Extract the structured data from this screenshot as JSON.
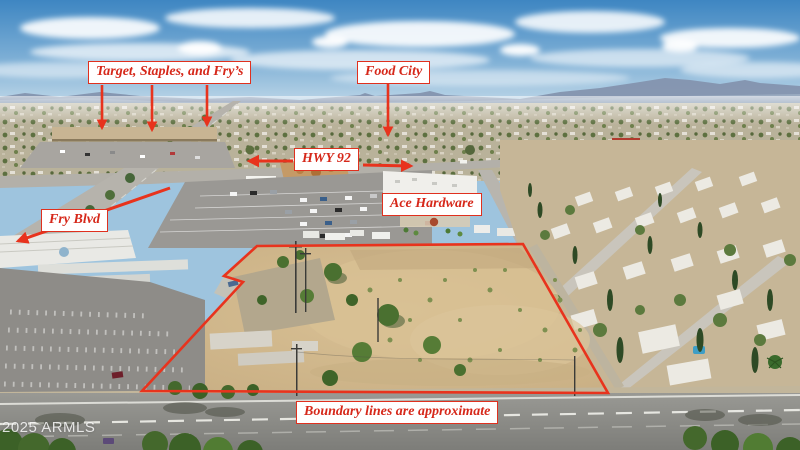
{
  "annotations": {
    "labels": [
      {
        "id": "target-staples-frys",
        "text": "Target, Staples, and Fry’s"
      },
      {
        "id": "food-city",
        "text": "Food City"
      },
      {
        "id": "hwy-92",
        "text": "HWY 92"
      },
      {
        "id": "fry-blvd",
        "text": "Fry Blvd"
      },
      {
        "id": "ace-hardware",
        "text": "Ace Hardware"
      },
      {
        "id": "boundary-note",
        "text": "Boundary lines are approximate"
      }
    ],
    "watermark": "2025 ARMLS",
    "colors": {
      "annotation_red": "#e8331d",
      "label_border_red": "#e0301e",
      "label_text_red": "#d6281a",
      "label_background": "#ffffff",
      "watermark_color": "#ffffff"
    }
  }
}
